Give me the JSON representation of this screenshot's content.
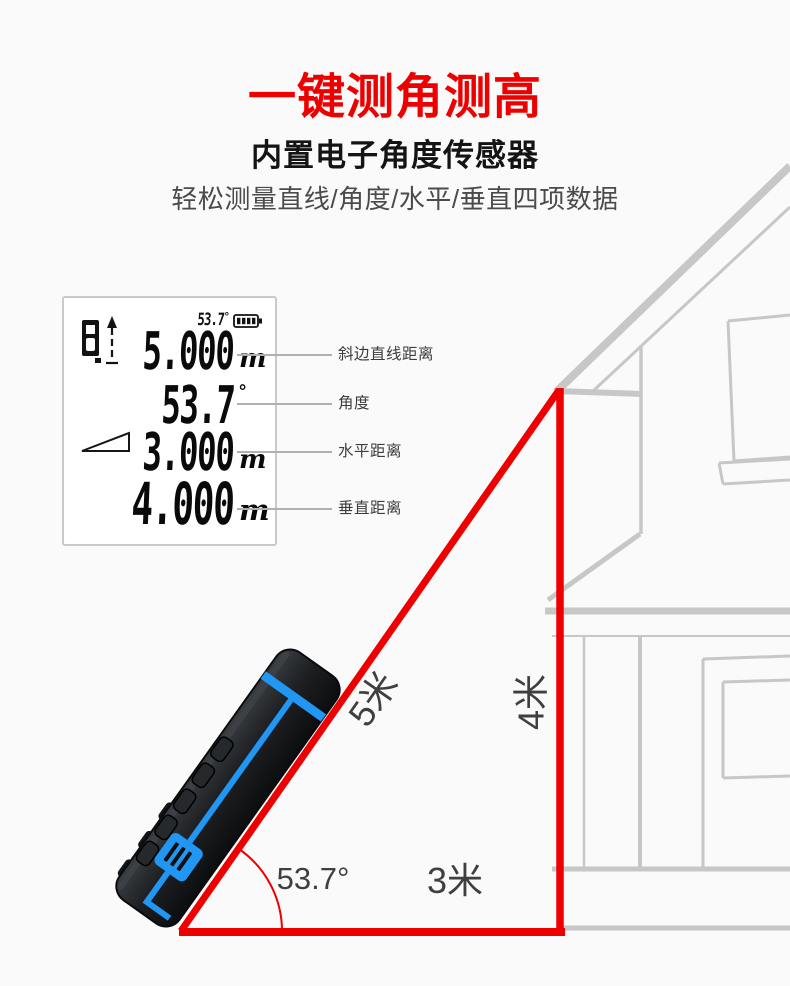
{
  "colors": {
    "accent_red": "#ee0000",
    "house_gray": "#c7c7c7",
    "device_blue": "#2196f3",
    "label_gray": "#3f3f3f"
  },
  "header": {
    "title": "一键测角测高",
    "subtitle": "内置电子角度传感器",
    "tagline": "轻松测量直线/角度/水平/垂直四项数据"
  },
  "lcd": {
    "status": {
      "value": "53.7",
      "degree": "°",
      "battery_icon": "battery-full-icon"
    },
    "reference_icon": "device-reference-icon",
    "angle_icon": "angle-triangle-icon",
    "rows": [
      {
        "value": "5.000",
        "unit": "m",
        "label": "斜边直线距离"
      },
      {
        "value": "53.7",
        "unit": "°",
        "label": "角度"
      },
      {
        "value": "3.000",
        "unit": "m",
        "label": "水平距离"
      },
      {
        "value": "4.000",
        "unit": "m",
        "label": "垂直距离"
      }
    ]
  },
  "diagram": {
    "hypotenuse_label": "5米",
    "vertical_label": "4米",
    "horizontal_label": "3米",
    "angle_label": "53.7°"
  }
}
